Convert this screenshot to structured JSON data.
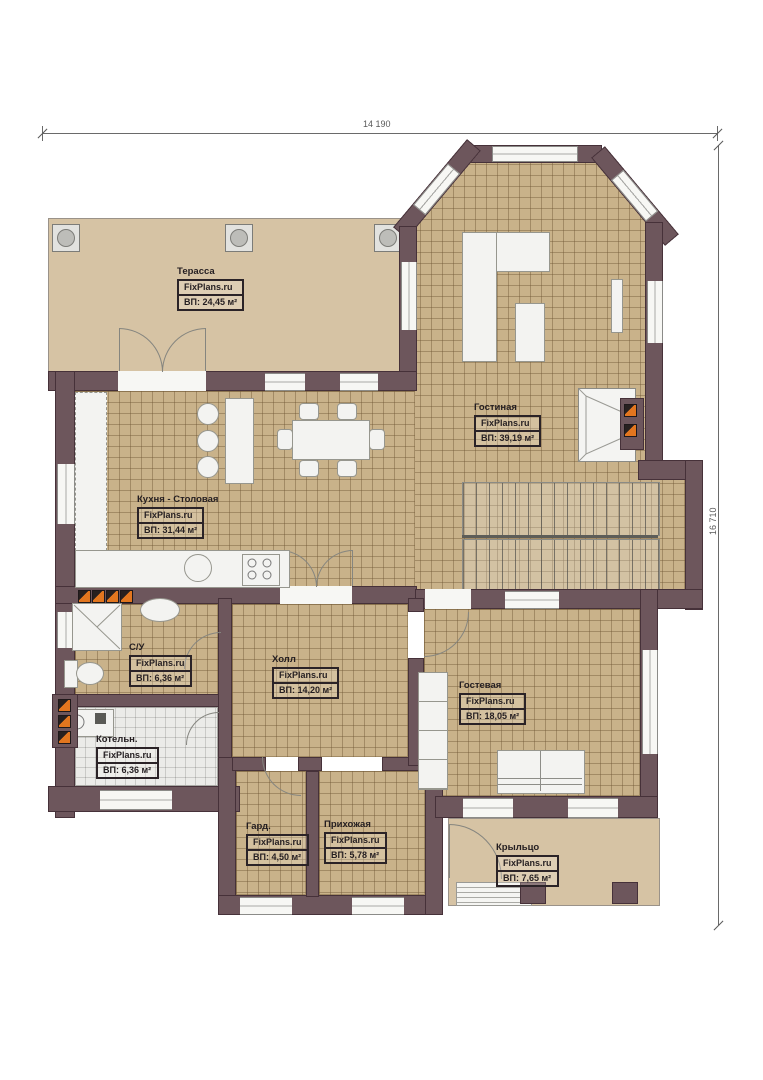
{
  "plan": {
    "type": "floor-plan",
    "source_watermark": "FixPlans.ru",
    "dimensions": {
      "top": "14 190",
      "right": "16 710"
    },
    "colors": {
      "wall": "#6d565c",
      "wall_outline": "#463139",
      "floor_tile": "#c9b28a",
      "terrace_floor": "#d6c3a4",
      "boiler_floor": "#ebebe8",
      "accent_orange": "#e2761f",
      "background": "#ffffff"
    }
  },
  "rooms": [
    {
      "id": "terrace",
      "name": "Терасса",
      "brand": "FixPlans.ru",
      "area": "ВП: 24,45 м²"
    },
    {
      "id": "living",
      "name": "Гостиная",
      "brand": "FixPlans.ru",
      "area": "ВП: 39,19 м²"
    },
    {
      "id": "kitchen",
      "name": "Кухня - Столовая",
      "brand": "FixPlans.ru",
      "area": "ВП:    31,44 м²"
    },
    {
      "id": "bathroom",
      "name": "С/У",
      "brand": "FixPlans.ru",
      "area": "ВП: 6,36 м²"
    },
    {
      "id": "hall",
      "name": "Холл",
      "brand": "FixPlans.ru",
      "area": "ВП: 14,20 м²"
    },
    {
      "id": "guest",
      "name": "Гостевая",
      "brand": "FixPlans.ru",
      "area": "ВП: 18,05 м²"
    },
    {
      "id": "boiler",
      "name": "Котельн.",
      "brand": "FixPlans.ru",
      "area": "ВП: 6,36 м²"
    },
    {
      "id": "wardrobe",
      "name": "Гард.",
      "brand": "FixPlans.ru",
      "area": "ВП: 4,50 м²"
    },
    {
      "id": "entry",
      "name": "Прихожая",
      "brand": "FixPlans.ru",
      "area": "ВП: 5,78 м²"
    },
    {
      "id": "porch",
      "name": "Крыльцо",
      "brand": "FixPlans.ru",
      "area": "ВП: 7,65 м²"
    }
  ]
}
